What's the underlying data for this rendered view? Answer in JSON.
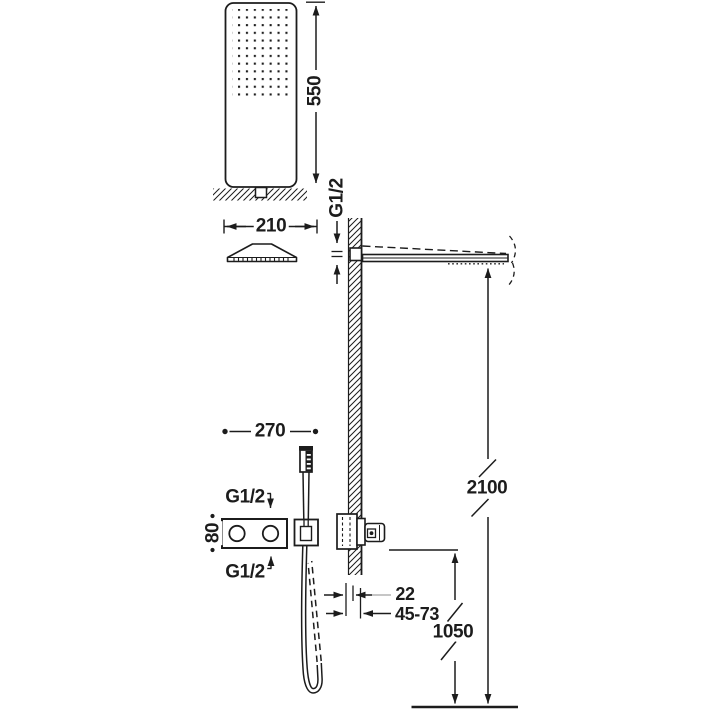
{
  "diagram": {
    "type": "shower-installation-technical-drawing",
    "dims": {
      "head_height": "550",
      "head_width": "210",
      "arm_thread": "G1/2",
      "arm_height_from_floor": "2100",
      "controls_span": "270",
      "inlet_top_thread": "G1/2",
      "inlet_bottom_thread": "G1/2",
      "controls_height": "80",
      "outlet_wall_offset": "22",
      "outlet_depth_range": "45-73",
      "outlet_height_from_floor": "1050"
    },
    "colors": {
      "line": "#1c1c1c",
      "leader": "#a5a5a5",
      "background": "#ffffff"
    }
  }
}
